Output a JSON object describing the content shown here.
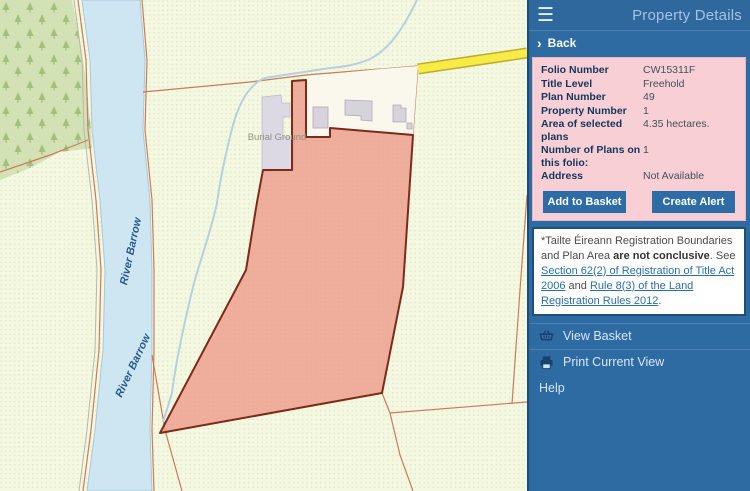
{
  "map": {
    "labels": {
      "river_label_1": "River Barrow",
      "river_label_2": "River Barrow",
      "burial_ground": "Burial Ground"
    },
    "colors": {
      "background": "#f4f7de",
      "forest": "#d3e2b4",
      "river": "#cde6f2",
      "parcel_fill": "#ee9a89",
      "parcel_outline": "#7b2b1b",
      "boundary_line": "#c97b5c",
      "road_yellow": "#f6ec45",
      "building": "#d6d3da",
      "burial_ground_fill": "#dcd9e4"
    }
  },
  "sidebar": {
    "title": "Property Details",
    "back_label": "Back",
    "details": {
      "rows": [
        {
          "label": "Folio Number",
          "value": "CW15311F"
        },
        {
          "label": "Title Level",
          "value": "Freehold"
        },
        {
          "label": "Plan Number",
          "value": "49"
        },
        {
          "label": "Property Number",
          "value": "1"
        },
        {
          "label": "Area of selected plans",
          "value": "4.35 hectares."
        },
        {
          "label": "Number of Plans on this folio:",
          "value": "1"
        },
        {
          "label": "Address",
          "value": "Not Available"
        }
      ]
    },
    "buttons": {
      "add_to_basket": "Add to Basket",
      "create_alert": "Create Alert"
    },
    "disclaimer": {
      "text1": "*Tailte Éireann Registration Boundaries and Plan Area ",
      "bold": "are not conclusive",
      "text2": ". See ",
      "link1": "Section 62(2) of Registration of Title Act 2006",
      "text3": " and ",
      "link2": "Rule 8(3) of the Land Registration Rules 2012",
      "text4": "."
    },
    "menu": {
      "view_basket": "View Basket",
      "print_current_view": "Print Current View",
      "help": "Help"
    }
  }
}
